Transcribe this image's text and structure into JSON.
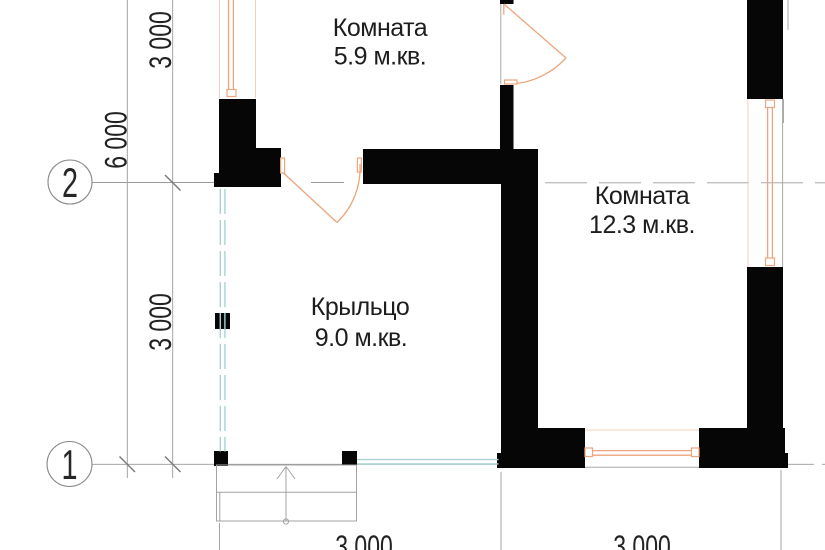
{
  "drawing": {
    "type": "architectural-floor-plan",
    "rooms": [
      {
        "name": "Комната",
        "area": "5.9 м.кв."
      },
      {
        "name": "Комната",
        "area": "12.3 м.кв."
      },
      {
        "name": "Крыльцо",
        "area": "9.0 м.кв."
      }
    ],
    "grid_axes": [
      {
        "label": "2"
      },
      {
        "label": "1"
      }
    ],
    "dimensions": {
      "left_total": "6 000",
      "left_upper_segment": "3 000",
      "left_lower_segment": "3 000",
      "bottom_left_segment": "3 000",
      "bottom_right_segment": "3 000"
    },
    "colors": {
      "wall_fill": "#060606",
      "opening_accent_orange": "#eda57d",
      "porch_glazing_cyan": "#a9d3d3",
      "drawing_line_gray": "#9a9a9a",
      "text": "#1d1d1d"
    }
  }
}
